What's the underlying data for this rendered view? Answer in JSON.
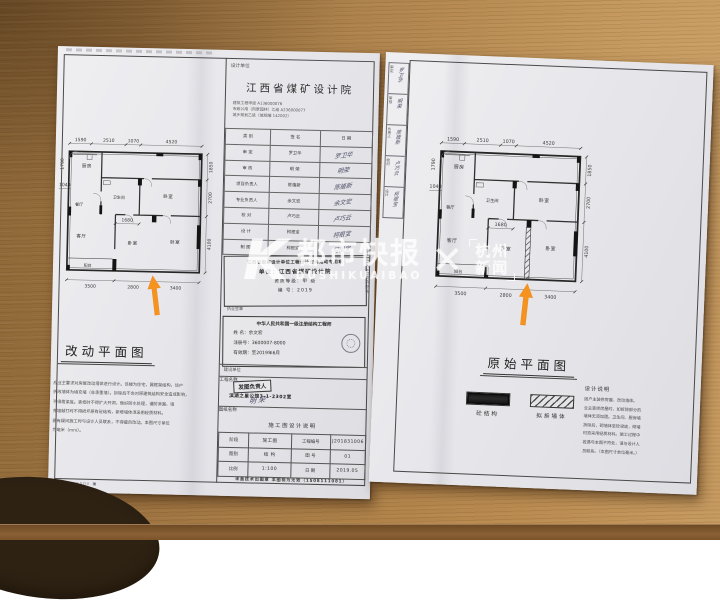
{
  "colors": {
    "arrow": "#f6921e",
    "paper": "#e9e9ed",
    "wood": "#a37844",
    "watermark": "#ffffff"
  },
  "watermark": {
    "logo": "K",
    "brand": "都市快报",
    "latin": "DUSHIKUAIBAO",
    "separator": "✕",
    "partner_top": "杭州",
    "partner_bottom": "新闻"
  },
  "plan": {
    "rooms": {
      "kitchen": "厨房",
      "bath": "卫生间",
      "bed_top": "卧室",
      "dining": "餐厅",
      "living": "客厅",
      "bed_mid": "卧室",
      "bed_right": "卧室",
      "balcony": "阳台"
    },
    "dims": {
      "top": [
        "1590",
        "2510",
        "1070",
        "4520"
      ],
      "left_v": "1790",
      "left_h": "1040",
      "right": [
        "1850",
        "2700",
        "4100"
      ],
      "bottom": [
        "3500",
        "2800",
        "3400"
      ],
      "mid": "1680"
    }
  },
  "left_page": {
    "plan_title": "改动平面图",
    "title_block": {
      "design_unit_label": "设计单位",
      "design_unit": "江西省煤矿设计院",
      "credentials": [
        "建筑工程甲级 A136000076",
        "市政公用（风景园林）乙级 A236000077",
        "城乡规划乙级（城规编 142002）"
      ]
    },
    "sign_table": {
      "headers": [
        "类 别",
        "签  名",
        "日 期"
      ],
      "rows": [
        [
          "审 定",
          "罗卫华",
          "罗卫华"
        ],
        [
          "审 核",
          "明 荣",
          "明荣"
        ],
        [
          "项目负责人",
          "陈植新",
          "陈植新"
        ],
        [
          "专业负责人",
          "余文宏",
          "余文宏"
        ],
        [
          "校 对",
          "卢巧云",
          "卢巧云"
        ],
        [
          "设 计",
          "柯根宝",
          "柯根宝"
        ],
        [
          "制 图",
          "柯根宝",
          "柯根宝"
        ]
      ]
    },
    "stamp_qualification": {
      "line1": "江西省勘察设计单位工程设计咨询活动专用章",
      "line2": "单位：江西省煤矿设计院",
      "line3": "资质等级：甲 级",
      "line4": "编 号：2019",
      "footer": "执业签章"
    },
    "stamp_engineer": {
      "title": "中华人民共和国一级注册结构工程师",
      "name": "姓 名：余文宏",
      "reg": "注册号：3600007-8000",
      "valid": "有效期：至2019年6月"
    },
    "client_label": "建设单位",
    "project_label": "工程名称",
    "project_value": "滨湖之星公馆3-1-2302室",
    "project_stamp": "发图负责人",
    "project_sign": "明 荣",
    "sheet_label": "图纸名称",
    "sheet_value": "施工图设计说明",
    "info_table": [
      [
        "阶段",
        "施工图",
        "工程编号",
        "J201831006"
      ],
      [
        "图别",
        "结 构",
        "图 号",
        "01"
      ],
      [
        "比例",
        "1:100",
        "日 期",
        "2019.05"
      ]
    ],
    "footer_note": "未盖技术出图章 本图视为无效（1508111081）",
    "side_note": "由AutoCAD软件制作",
    "edge_mark": "▣ vcannnnv ▣",
    "notes": [
      "应业主要求对房屋改动墙体进行设计。该楼为住宅，属框架结构，该户",
      "拆改墙体为填充墙（非承重墙）。拆除后不会对原建筑结构安全造成影响，",
      "不得凿梁底。装修时不得扩大开洞，做好防水处理，谨防渗漏，填",
      "充墙敲打时不得损坏原有砼结构，新增墙体须采用轻质材料。",
      "若有疑问施工时与设计人员联系，不得擅自改动。本图尺寸单位",
      "为毫米（mm）。"
    ]
  },
  "right_page": {
    "plan_title": "原始平面图",
    "strip_cells": [
      [
        "审定",
        "罗卫华"
      ],
      [
        "审核",
        "明荣"
      ],
      [
        "负责人",
        "陈植新"
      ],
      [
        "校对",
        "卢巧云"
      ],
      [
        "设计",
        "柯根宝"
      ]
    ],
    "legend": [
      {
        "label": "砼结构"
      },
      {
        "label": "拟拆墙体"
      }
    ],
    "design_notes_title": "设计说明",
    "design_notes": [
      "因户主装修房屋，改动墙体。",
      "业主装修房屋时，如拆除部分的",
      "墙体无须加固。卫生间、厨房墙",
      "拆除后，砌墙体至砼梁底，砌墙",
      "时须采用轻质材料。施工过程中",
      "若遇与本图不符处，请与设计人",
      "员联系。（本图尺寸单位毫米。）"
    ]
  }
}
